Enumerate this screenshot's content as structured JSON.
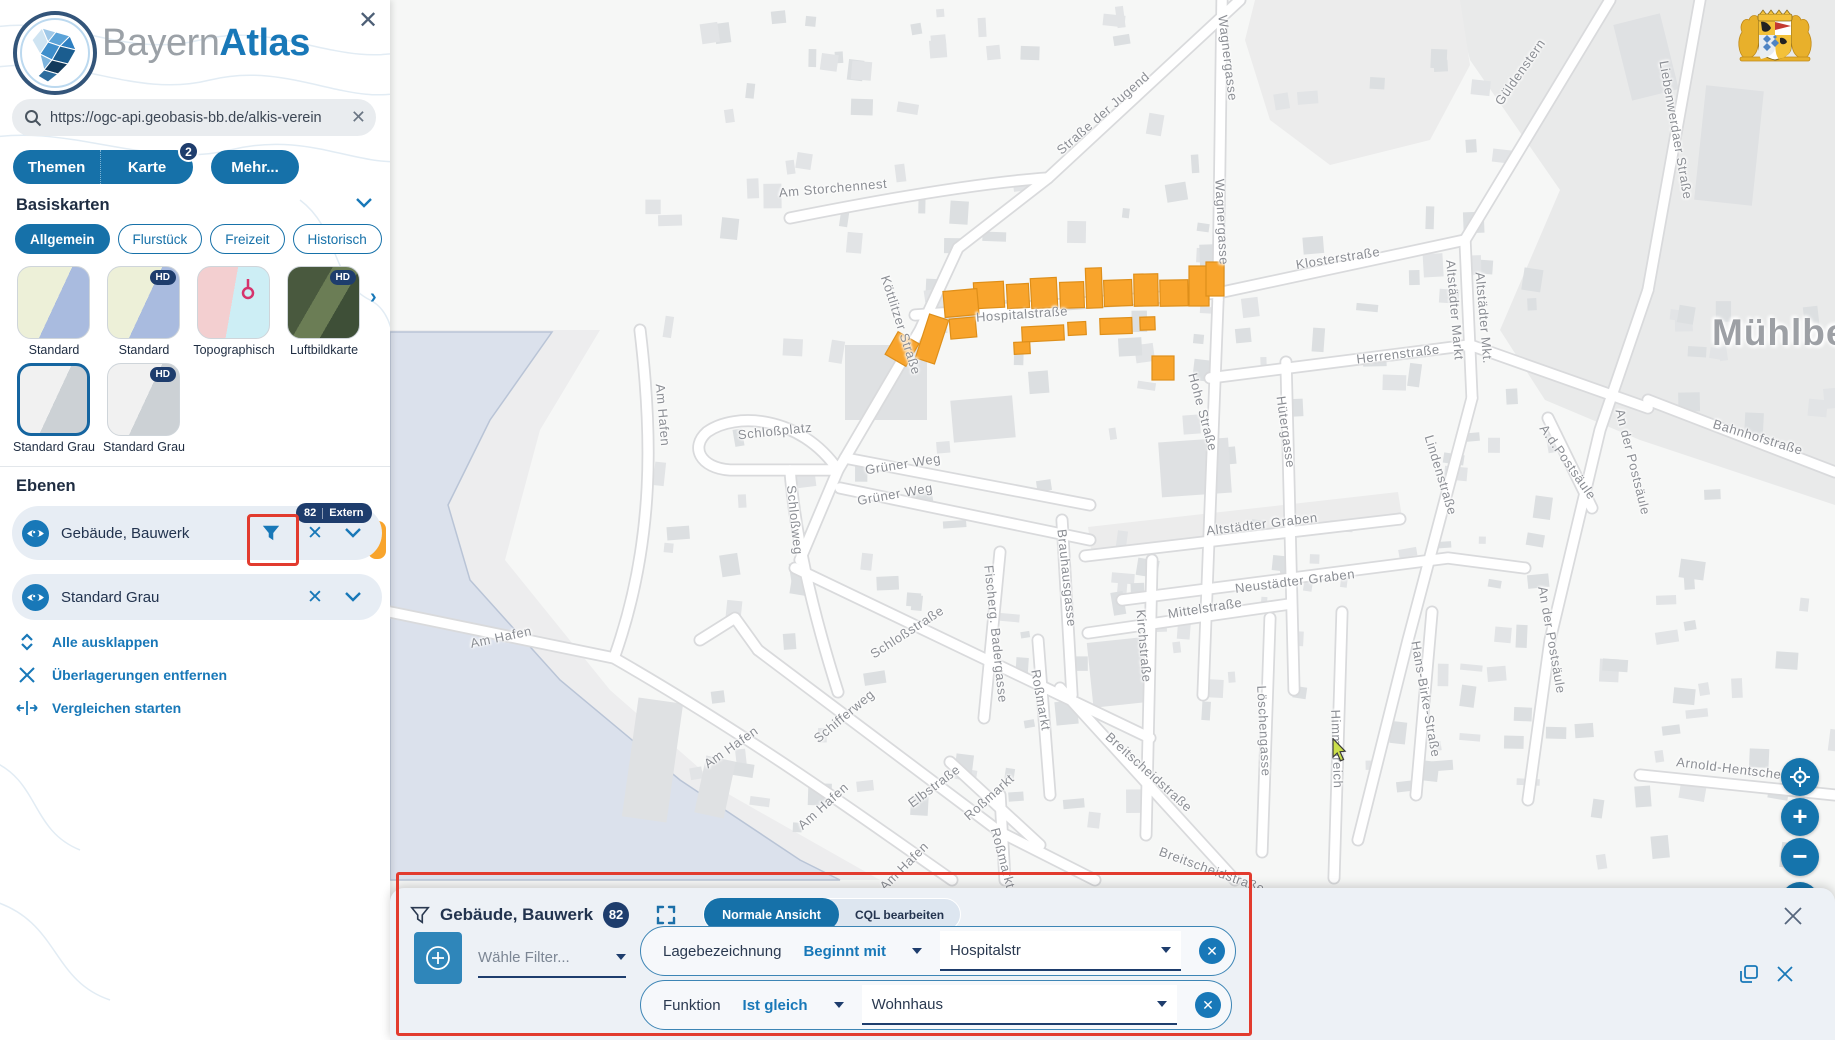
{
  "header": {
    "brand_gray": "Bayern",
    "brand_blue": "Atlas"
  },
  "search": {
    "value": "https://ogc-api.geobasis-bb.de/alkis-verein"
  },
  "tabs": {
    "themen": "Themen",
    "karte": "Karte",
    "karte_badge": "2",
    "mehr": "Mehr..."
  },
  "basiskarten": {
    "title": "Basiskarten",
    "hd_label": "HD",
    "chips": [
      {
        "label": "Allgemein",
        "active": true
      },
      {
        "label": "Flurstück",
        "active": false
      },
      {
        "label": "Freizeit",
        "active": false
      },
      {
        "label": "Historisch",
        "active": false
      }
    ],
    "maps": [
      {
        "label": "Standard"
      },
      {
        "label": "Standard"
      },
      {
        "label": "Topographisch"
      },
      {
        "label": "Luftbildkarte"
      },
      {
        "label": "Standard Grau"
      },
      {
        "label": "Standard Grau"
      }
    ]
  },
  "ebenen": {
    "title": "Ebenen",
    "layers": [
      {
        "label": "Gebäude, Bauwerk",
        "badge_count": "82",
        "badge_text": "Extern"
      },
      {
        "label": "Standard Grau"
      }
    ],
    "actions": [
      {
        "label": "Alle ausklappen"
      },
      {
        "label": "Überlagerungen entfernen"
      },
      {
        "label": "Vergleichen starten"
      }
    ]
  },
  "filter_panel": {
    "title": "Gebäude, Bauwerk",
    "badge": "82",
    "view_active": "Normale Ansicht",
    "view_inactive": "CQL bearbeiten",
    "filter_placeholder": "Wähle Filter...",
    "rows": [
      {
        "field": "Lagebezeichnung",
        "operator": "Beginnt mit",
        "value": "Hospitalstr"
      },
      {
        "field": "Funktion",
        "operator": "Ist gleich",
        "value": "Wohnhaus"
      }
    ]
  },
  "map": {
    "city_label": "Mühlberg",
    "street_labels": [
      {
        "t": "Wagnergasse",
        "x": 1228,
        "y": 58,
        "r": 83
      },
      {
        "t": "Wagnergasse",
        "x": 1222,
        "y": 222,
        "r": 87
      },
      {
        "t": "Straße der Jugend",
        "x": 1103,
        "y": 113,
        "r": -41
      },
      {
        "t": "Am Storchennest",
        "x": 833,
        "y": 188,
        "r": -5
      },
      {
        "t": "Güldenstern",
        "x": 1520,
        "y": 72,
        "r": -55
      },
      {
        "t": "Liebenwerdaer Straße",
        "x": 1676,
        "y": 130,
        "r": 80
      },
      {
        "t": "Klosterstraße",
        "x": 1338,
        "y": 258,
        "r": -9
      },
      {
        "t": "Altstädter Markt",
        "x": 1455,
        "y": 310,
        "r": 85
      },
      {
        "t": "Altstädter Mkt.",
        "x": 1484,
        "y": 318,
        "r": 85
      },
      {
        "t": "Herrenstraße",
        "x": 1398,
        "y": 354,
        "r": -7
      },
      {
        "t": "Köttlitzer Straße",
        "x": 901,
        "y": 325,
        "r": 72
      },
      {
        "t": "Hospitalstraße",
        "x": 1022,
        "y": 314,
        "r": -4
      },
      {
        "t": "Hohe Straße",
        "x": 1203,
        "y": 412,
        "r": 75
      },
      {
        "t": "Hütergasse",
        "x": 1286,
        "y": 432,
        "r": 82
      },
      {
        "t": "Lindenstraße",
        "x": 1441,
        "y": 475,
        "r": 73
      },
      {
        "t": "An der Postsäule",
        "x": 1633,
        "y": 462,
        "r": 76
      },
      {
        "t": "A.d.Postsäule",
        "x": 1568,
        "y": 462,
        "r": 55
      },
      {
        "t": "An der Postsäule",
        "x": 1552,
        "y": 640,
        "r": 80
      },
      {
        "t": "Bahnhofstraße",
        "x": 1758,
        "y": 437,
        "r": 17
      },
      {
        "t": "Altstädter Graben",
        "x": 1262,
        "y": 524,
        "r": -7
      },
      {
        "t": "Neustädter Graben",
        "x": 1295,
        "y": 581,
        "r": -7
      },
      {
        "t": "Mittelstraße",
        "x": 1205,
        "y": 608,
        "r": -9
      },
      {
        "t": "Schloßplatz",
        "x": 775,
        "y": 431,
        "r": -6
      },
      {
        "t": "Grüner Weg",
        "x": 903,
        "y": 464,
        "r": -9
      },
      {
        "t": "Grüner Weg",
        "x": 895,
        "y": 494,
        "r": -10
      },
      {
        "t": "Schloßweg",
        "x": 795,
        "y": 520,
        "r": 84
      },
      {
        "t": "Brauhausgasse",
        "x": 1067,
        "y": 578,
        "r": 84
      },
      {
        "t": "Kirchstraße",
        "x": 1144,
        "y": 646,
        "r": 85
      },
      {
        "t": "Schloßstraße",
        "x": 907,
        "y": 632,
        "r": -33
      },
      {
        "t": "Fischerg. Badergasse",
        "x": 996,
        "y": 634,
        "r": 84
      },
      {
        "t": "Roßmarkt",
        "x": 1041,
        "y": 700,
        "r": 80
      },
      {
        "t": "Roßmarkt",
        "x": 989,
        "y": 797,
        "r": -42
      },
      {
        "t": "Roßmarkt",
        "x": 1003,
        "y": 858,
        "r": 75
      },
      {
        "t": "Löschengasse",
        "x": 1264,
        "y": 731,
        "r": 87
      },
      {
        "t": "Himmelreich",
        "x": 1337,
        "y": 749,
        "r": 88
      },
      {
        "t": "Breitscheidstraße",
        "x": 1149,
        "y": 772,
        "r": 42
      },
      {
        "t": "Breitscheidstraße",
        "x": 1212,
        "y": 870,
        "r": 20
      },
      {
        "t": "Elbstraße",
        "x": 934,
        "y": 786,
        "r": -37
      },
      {
        "t": "Schifferweg",
        "x": 844,
        "y": 716,
        "r": -40
      },
      {
        "t": "Am Hafen",
        "x": 663,
        "y": 415,
        "r": 85
      },
      {
        "t": "Am Hafen",
        "x": 501,
        "y": 637,
        "r": -12
      },
      {
        "t": "Am Hafen",
        "x": 731,
        "y": 747,
        "r": -35
      },
      {
        "t": "Am Hafen",
        "x": 823,
        "y": 806,
        "r": -42
      },
      {
        "t": "Am Hafen",
        "x": 904,
        "y": 866,
        "r": -45
      },
      {
        "t": "Hans-Birke-Straße",
        "x": 1426,
        "y": 699,
        "r": 80
      },
      {
        "t": "Arnold-Hentschel-Str.",
        "x": 1744,
        "y": 770,
        "r": 7
      }
    ],
    "highlighted_buildings": [
      [
        974,
        282,
        30,
        26,
        -3
      ],
      [
        1007,
        284,
        22,
        24,
        -3
      ],
      [
        1031,
        278,
        26,
        30,
        -3
      ],
      [
        1060,
        282,
        24,
        26,
        -2
      ],
      [
        1086,
        268,
        16,
        40,
        -2
      ],
      [
        1104,
        280,
        28,
        26,
        -2
      ],
      [
        1134,
        274,
        24,
        32,
        -1
      ],
      [
        1160,
        280,
        28,
        26,
        -1
      ],
      [
        1189,
        266,
        20,
        40,
        0
      ],
      [
        1206,
        262,
        18,
        34,
        0
      ],
      [
        944,
        290,
        34,
        26,
        -5
      ],
      [
        950,
        318,
        26,
        20,
        -5
      ],
      [
        922,
        316,
        20,
        46,
        18
      ],
      [
        890,
        336,
        24,
        26,
        30
      ],
      [
        1022,
        326,
        42,
        15,
        -3
      ],
      [
        1068,
        322,
        18,
        13,
        -3
      ],
      [
        1100,
        318,
        32,
        16,
        -2
      ],
      [
        1140,
        317,
        15,
        13,
        -2
      ],
      [
        1014,
        342,
        16,
        12,
        -3
      ],
      [
        1152,
        356,
        22,
        24,
        0
      ]
    ]
  }
}
